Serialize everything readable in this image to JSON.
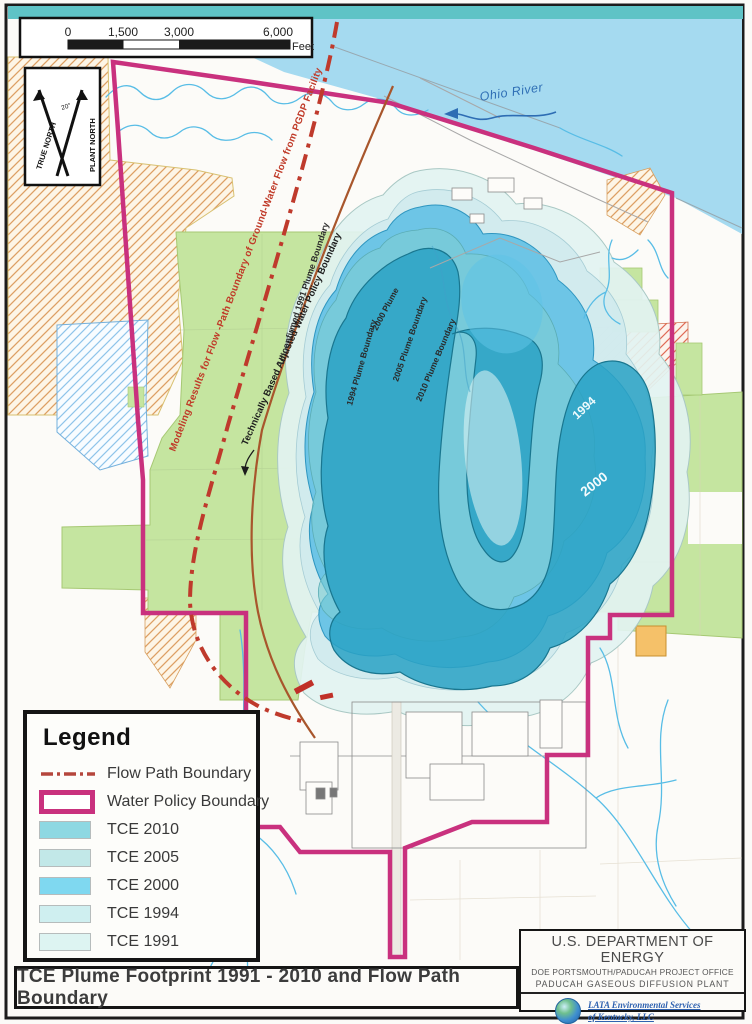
{
  "title_bar": {
    "text": "TCE Plume Footprint 1991 - 2010 and Flow Path Boundary"
  },
  "scale_bar": {
    "tick0": "0",
    "tick1": "1,500",
    "tick2": "3,000",
    "tick3": "6,000",
    "unit": "Feet"
  },
  "north_arrow": {
    "true_north": "TRUE NORTH",
    "plant_north": "PLANT NORTH",
    "angle": "20°"
  },
  "map_labels": {
    "river": "Ohio River",
    "flow_model": "Modeling Results for Flow -Path Boundary of Ground-Water Flow from PGDP Facility",
    "adjusted_policy": "Technically Based Adjusted Water Policy Boundary",
    "unconfirmed_1991": "Unconfirmed 1991 Plume Boundary",
    "plume_1994": "1994 Plume Boundary",
    "plume_2000": "2000 Plume",
    "plume_2005": "2005 Plume Boundary",
    "plume_2010": "2010 Plume Boundary",
    "year_1994": "1994",
    "year_2000": "2000"
  },
  "legend": {
    "title": "Legend",
    "items": [
      {
        "label": "Flow Path Boundary",
        "type": "flow-path-line",
        "color": "#b5463c"
      },
      {
        "label": "Water Policy Boundary",
        "type": "boundary-outline",
        "color": "#c9317e"
      },
      {
        "label": "TCE 2010",
        "type": "fill",
        "color": "#8ed8e2"
      },
      {
        "label": "TCE 2005",
        "type": "fill",
        "color": "#c2e8e8"
      },
      {
        "label": "TCE 2000",
        "type": "fill",
        "color": "#7fd8f0"
      },
      {
        "label": "TCE 1994",
        "type": "fill",
        "color": "#cfeff0"
      },
      {
        "label": "TCE 1991",
        "type": "fill",
        "color": "#ddf4f2"
      }
    ]
  },
  "agency_box": {
    "line1": "U.S. DEPARTMENT OF ENERGY",
    "line2": "DOE PORTSMOUTH/PADUCAH PROJECT OFFICE",
    "line3": "PADUCAH GASEOUS DIFFUSION PLANT",
    "logo_name": "LATA Environmental Services",
    "logo_sub": "of Kentucky, LLC"
  }
}
